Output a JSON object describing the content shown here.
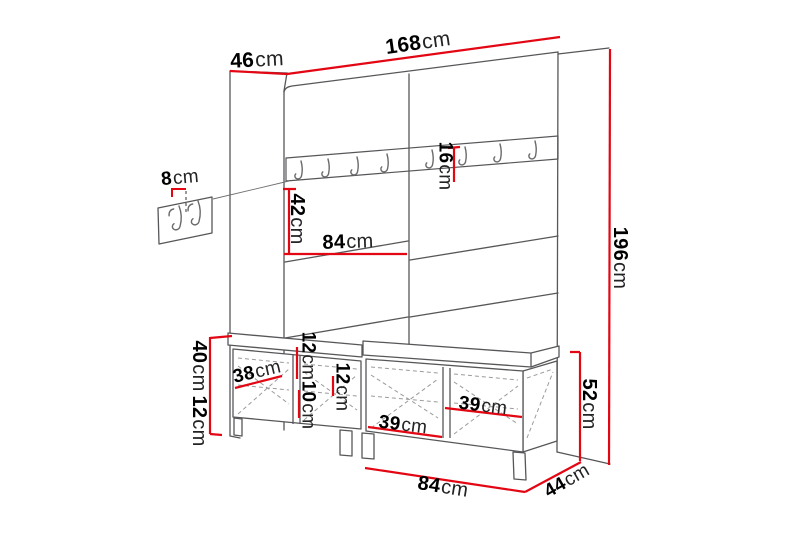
{
  "diagram": {
    "description": "Hallway furniture set dimension drawing: tall wall panel with coat-hook rail, small wall hook panel, and two shoe benches with seat cushions",
    "dimension_color": "#e30613",
    "outline_color": "#57575a",
    "labels": {
      "depth_top": {
        "value": "46",
        "unit": "cm"
      },
      "width_top": {
        "value": "168",
        "unit": "cm"
      },
      "wall_hooks_panel": {
        "value": "8",
        "unit": "cm"
      },
      "hook_rail": {
        "value": "16",
        "unit": "cm"
      },
      "panel_upper": {
        "value": "42",
        "unit": "cm"
      },
      "panel_half_width": {
        "value": "84",
        "unit": "cm"
      },
      "overall_height": {
        "value": "196",
        "unit": "cm"
      },
      "bench_body_height": {
        "value": "40",
        "unit": "cm"
      },
      "bench_leg_height": {
        "value": "12",
        "unit": "cm"
      },
      "door_left": {
        "value": "38",
        "unit": "cm"
      },
      "seat_left": {
        "value": "12",
        "unit": "cm"
      },
      "shelf_left": {
        "value": "10",
        "unit": "cm"
      },
      "seat_right": {
        "value": "12",
        "unit": "cm"
      },
      "compartment_left": {
        "value": "39",
        "unit": "cm"
      },
      "compartment_right": {
        "value": "39",
        "unit": "cm"
      },
      "bench_width": {
        "value": "84",
        "unit": "cm"
      },
      "bench_depth": {
        "value": "44",
        "unit": "cm"
      },
      "bench_total_height": {
        "value": "52",
        "unit": "cm"
      }
    }
  }
}
